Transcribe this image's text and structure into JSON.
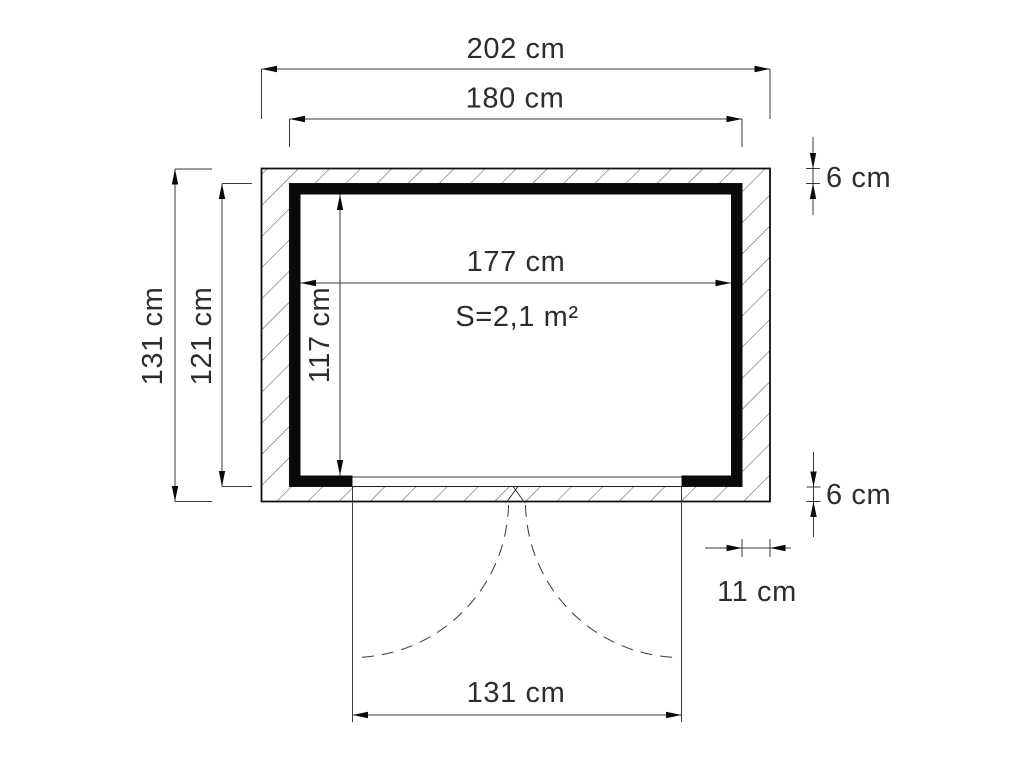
{
  "drawing": {
    "type": "shed-floor-plan-top-view",
    "labels": {
      "outer_width": "202 cm",
      "frame_width": "180 cm",
      "outer_height": "131 cm",
      "frame_height": "121 cm",
      "interior_width": "177 cm",
      "interior_height": "117 cm",
      "area": "S=2,1 m²",
      "wall_thickness_top": "6 cm",
      "wall_thickness_bottom": "6 cm",
      "side_wall_thickness": "11 cm",
      "door_opening_width": "131 cm"
    },
    "colors": {
      "background": "#ffffff",
      "wall_liner": "#0a0a0a",
      "hatch_line": "#5a5a5a",
      "dimension_line": "#3a3a3a",
      "text": "#2d2d2d"
    }
  }
}
